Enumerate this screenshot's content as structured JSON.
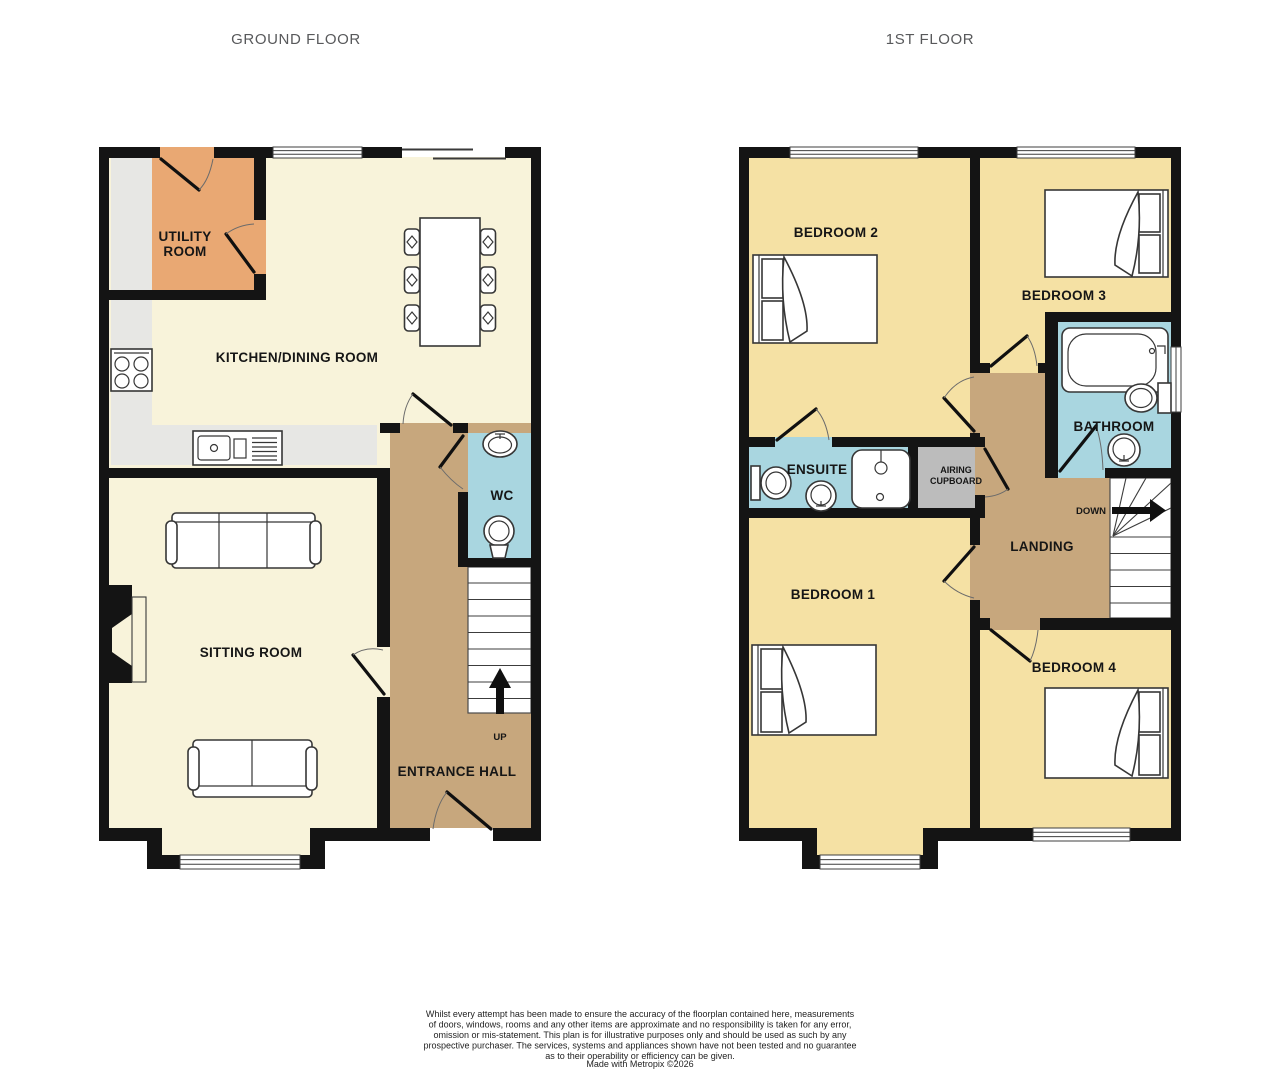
{
  "titles": {
    "ground": "GROUND FLOOR",
    "first": "1ST FLOOR"
  },
  "ground": {
    "utility1": "UTILITY",
    "utility2": "ROOM",
    "kitchen": "KITCHEN/DINING ROOM",
    "wc": "WC",
    "sitting": "SITTING ROOM",
    "hall": "ENTRANCE HALL",
    "up": "UP"
  },
  "first": {
    "bedroom2": "BEDROOM 2",
    "bedroom3": "BEDROOM 3",
    "bathroom": "BATHROOM",
    "ensuite": "ENSUITE",
    "airing1": "AIRING",
    "airing2": "CUPBOARD",
    "landing": "LANDING",
    "down": "DOWN",
    "bedroom1": "BEDROOM 1",
    "bedroom4": "BEDROOM 4"
  },
  "footer": {
    "line1": "Whilst every attempt has been made to ensure the accuracy of the floorplan contained here, measurements",
    "line2": "of doors, windows, rooms and any other items are approximate and no responsibility is taken for any error,",
    "line3": "omission or mis-statement. This plan is for illustrative purposes only and should be used as such by any",
    "line4": "prospective purchaser. The services, systems and appliances shown have not been tested and no guarantee",
    "line5": "as to their operability or efficiency can be given.",
    "credit": "Made with Metropix ©2026"
  },
  "colors": {
    "wall": "#141414",
    "cream": "#f8f3da",
    "yellow": "#f5e1a4",
    "orange": "#e9a873",
    "blue": "#a9d6e0",
    "brown": "#c7a77d",
    "cupboard": "#bcbcbc",
    "counter": "#e7e7e4",
    "title": "#58595b"
  }
}
